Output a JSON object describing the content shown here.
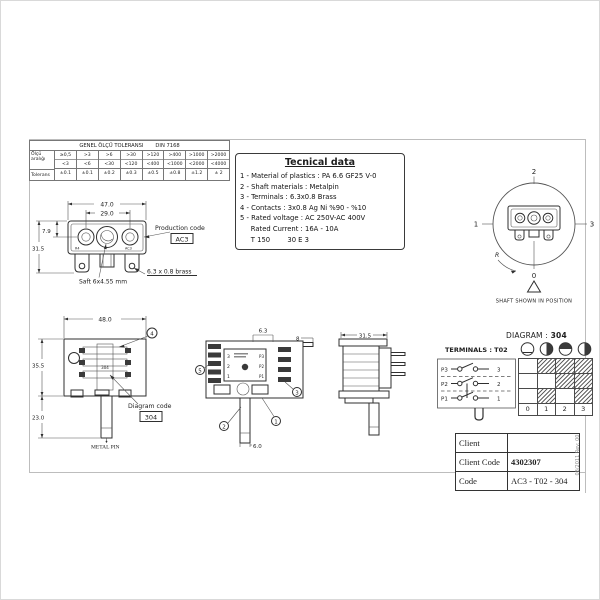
{
  "drawing": {
    "revision_note": "08/2011 Rev: 00"
  },
  "tolerance_table": {
    "title": "GENEL ÖLÇÜ TOLERANSI",
    "standard": "DIN 7168",
    "row_labels": {
      "range_line1": "Ölçü",
      "range_line2": "aralığı",
      "tolerance": "Tolerans"
    },
    "columns": [
      {
        "upper": "≥0,5",
        "lower": "<3",
        "tolerance": "±0.1"
      },
      {
        "upper": ">3",
        "lower": "<6",
        "tolerance": "±0.1"
      },
      {
        "upper": ">6",
        "lower": "<30",
        "tolerance": "±0.2"
      },
      {
        "upper": ">30",
        "lower": "<120",
        "tolerance": "±0.3"
      },
      {
        "upper": ">120",
        "lower": "<400",
        "tolerance": "±0.5"
      },
      {
        "upper": ">400",
        "lower": "<1000",
        "tolerance": "±0.8"
      },
      {
        "upper": ">1000",
        "lower": "<2000",
        "tolerance": "±1.2"
      },
      {
        "upper": ">2000",
        "lower": "<4000",
        "tolerance": "± 2"
      }
    ]
  },
  "technical_data": {
    "title": "Tecnical data",
    "lines": [
      "1 - Material of plastics : PA 6.6 GF25 V-0",
      "2 - Shaft materials : Metalpin",
      "3 - Terminals : 6.3x0.8 Brass",
      "4 - Contacts : 3x0.8 Ag Ni %90 - %10",
      "5 - Rated voltage : AC 250V-AC 400V",
      "     Rated Current : 16A - 10A",
      "     T 150        30 E 3"
    ]
  },
  "front_view": {
    "dim_width": "47.0",
    "dim_hole_spacing": "29.0",
    "dim_shaft_offset": "7.9",
    "dim_height": "31.5",
    "production_code_label": "Production code",
    "production_code": "AC3",
    "terminal_note": "6.3 x 0.8 brass",
    "shaft_note": "Saft 6x4.55 mm",
    "face_mark_left": "R4",
    "face_mark_right": "AC3"
  },
  "bottom_view": {
    "dim_width": "48.0",
    "dim_height": "35.5",
    "dim_pin_length": "23.0",
    "inner_code": "304",
    "diagram_code_label": "Diagram code",
    "diagram_code": "304",
    "pin_label": "METAL PIN",
    "marker": "4"
  },
  "top_view": {
    "dim_terminal_width": "6.3",
    "dim_terminal_length": "8",
    "dim_shaft_width": "6.0",
    "markers": {
      "label_plate": "5",
      "terminal": "3",
      "body": "1",
      "shaft": "2"
    },
    "plate_rows_left": [
      "3",
      "2",
      "1"
    ],
    "plate_rows_right": [
      "P3",
      "P2",
      "P1"
    ]
  },
  "side_view": {
    "dim_height": "31.5"
  },
  "shaft_position": {
    "pos_top": "2",
    "pos_left": "1",
    "pos_right": "3",
    "pos_bottom": "0",
    "rotation_mark": "R",
    "caption": "SHAFT SHOWN IN POSITION"
  },
  "diagram_section": {
    "title_label": "DIAGRAM :",
    "title_value": "304",
    "terminals_label": "TERMINALS : T02",
    "switch_rows": [
      {
        "pole": "P3",
        "terminal": "3"
      },
      {
        "pole": "P2",
        "terminal": "2"
      },
      {
        "pole": "P1",
        "terminal": "1"
      }
    ],
    "positions": [
      "0",
      "1",
      "2",
      "3"
    ],
    "contact_grid": [
      {
        "terminal": "3",
        "closed_at": [
          0,
          1,
          1,
          1
        ]
      },
      {
        "terminal": "2",
        "closed_at": [
          0,
          0,
          1,
          1
        ]
      },
      {
        "terminal": "1",
        "closed_at": [
          0,
          1,
          0,
          1
        ]
      }
    ]
  },
  "title_block": {
    "rows": [
      {
        "label": "Client",
        "value": ""
      },
      {
        "label": "Client Code",
        "value": "4302307"
      },
      {
        "label": "Code",
        "value": "AC3 - T02 - 304"
      }
    ]
  }
}
